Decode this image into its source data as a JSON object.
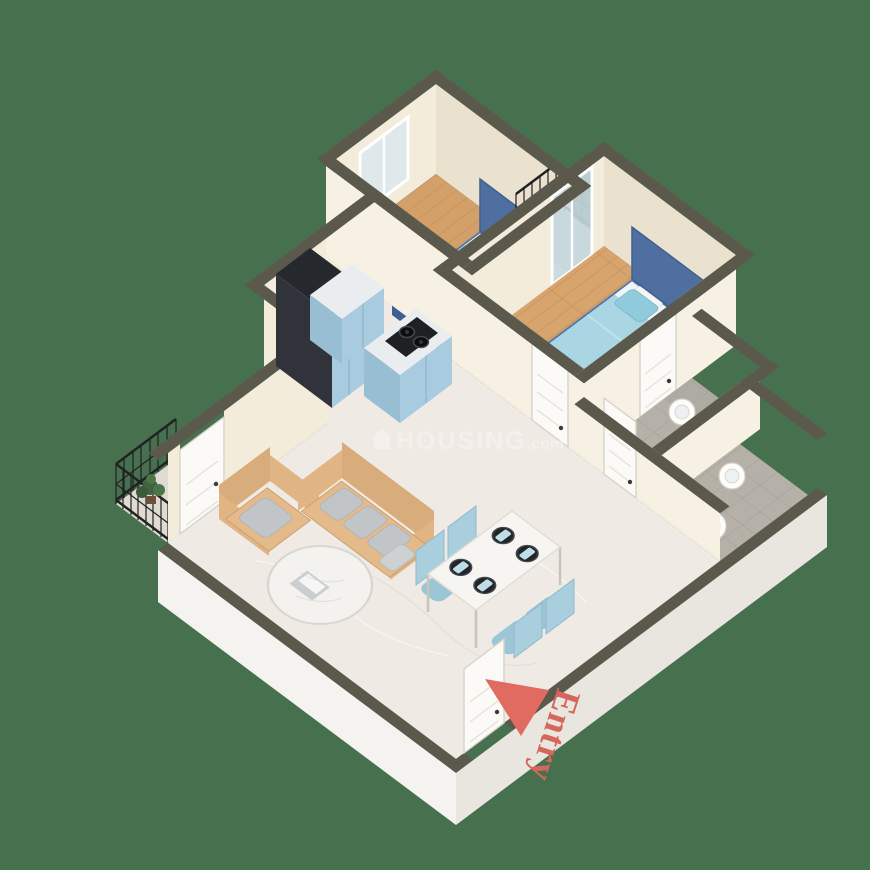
{
  "scene": {
    "type": "isometric-3d-floor-plan",
    "description": "3D dollhouse render of a 2BHK apartment floor plan on a plain green background"
  },
  "labels": {
    "entry": {
      "text": "Entry",
      "color": "#d5665c",
      "arrow_color": "#e16b60"
    }
  },
  "watermark": {
    "brand": "HOUSING",
    "suffix": ".com",
    "color": "#ffffff",
    "opacity": 0.34,
    "icon": "house-icon"
  },
  "palette": {
    "background": "#47704e",
    "wall_top": "#5b594b",
    "wall_face_cream": "#f3ecdb",
    "wall_face_white": "#f5f3ef",
    "wood_floor": "#d3a06a",
    "wood_plank_line": "#c39058",
    "marble_floor": "#efeae4",
    "tile_floor": "#b5b1a9",
    "tile_line": "#a29d94",
    "balcony_floor": "#e0dbd2",
    "bed_frame_blue": "#4e6f9f",
    "bed_duvet": "#a9d6e2",
    "pillow_aqua": "#8fcbdc",
    "sofa_tan": "#e4ba8b",
    "sofa_pillow_gray": "#c2c5c7",
    "cabinet_blue": "#a8cbdf",
    "cabinet_dark": "#30343a",
    "hob_black": "#1e2023",
    "dining_chair_blue": "#a9cedd",
    "railing_black": "#202221",
    "plant_green": "#41633f",
    "door_white": "#fbfaf7"
  },
  "rooms": [
    {
      "name": "Bedroom 1",
      "floor": "wood",
      "furniture": [
        "double-bed",
        "window"
      ]
    },
    {
      "name": "Bedroom 2",
      "floor": "wood",
      "furniture": [
        "double-bed",
        "french-door"
      ]
    },
    {
      "name": "Living Room",
      "floor": "marble",
      "furniture": [
        "three-seater-sofa",
        "armchair",
        "round-coffee-table"
      ]
    },
    {
      "name": "Kitchen",
      "floor": "marble",
      "furniture": [
        "tall-cabinet",
        "base-counter",
        "island-with-gas-hob"
      ]
    },
    {
      "name": "Dining Area",
      "floor": "marble",
      "furniture": [
        "dining-table",
        "four-chairs",
        "place-settings"
      ]
    },
    {
      "name": "Bathroom 1",
      "floor": "tile",
      "furniture": [
        "washbasin",
        "toilet"
      ]
    },
    {
      "name": "Bathroom 2",
      "floor": "tile",
      "furniture": [
        "washbasin",
        "toilet"
      ]
    },
    {
      "name": "North Balcony",
      "floor": "plain",
      "furniture": [
        "iron-railing"
      ]
    },
    {
      "name": "West Balcony",
      "floor": "plain",
      "furniture": [
        "iron-railing",
        "potted-plants"
      ]
    }
  ]
}
